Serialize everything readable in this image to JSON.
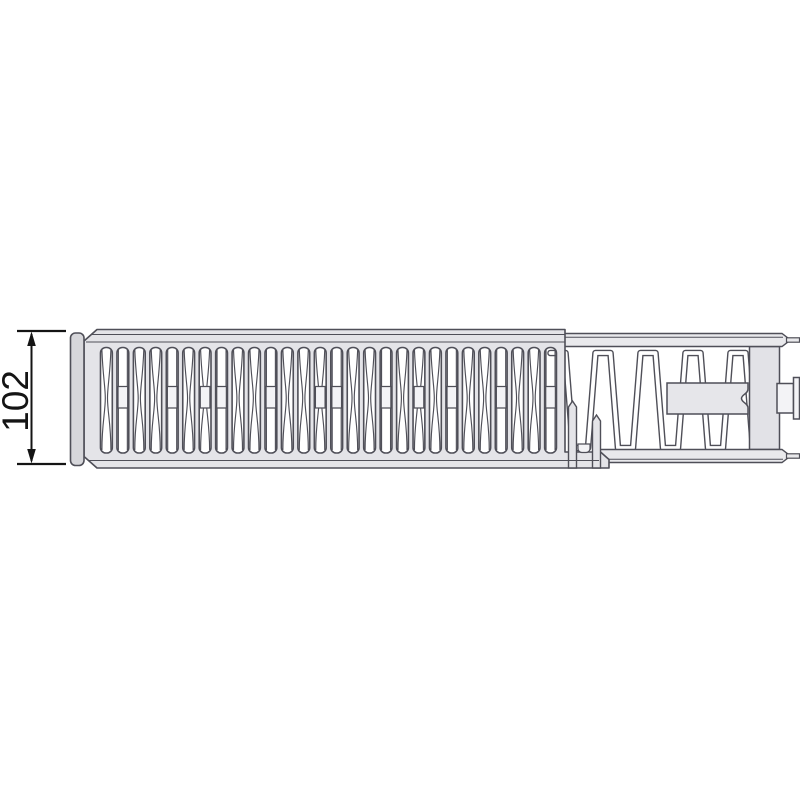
{
  "drawing": {
    "title": "radiator-top-section-view",
    "dimension": {
      "label": "102"
    },
    "grille": {
      "slot_count": 28,
      "motif_sequence": "ABAABACBAABAACBAABACABAABAAB"
    },
    "colors": {
      "background": "#ffffff",
      "outline": "#4f4f58",
      "dim": "#141414",
      "grille": "#e4e4e8",
      "band": "#e9e9ec",
      "bar": "#e2e2e7",
      "panel": "#e6e6ea",
      "cap": "#d7d7db",
      "slot": "#f3f3f6",
      "fin_gap": "#ffffff"
    }
  }
}
